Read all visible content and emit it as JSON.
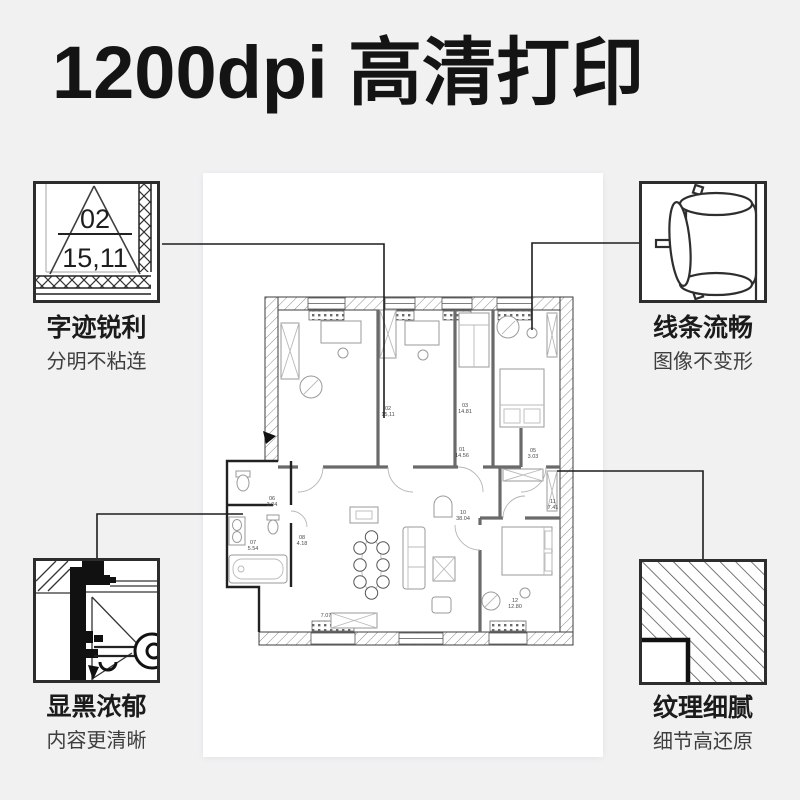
{
  "title": "1200dpi 高清打印",
  "features": {
    "top_left": {
      "title": "字迹锐利",
      "subtitle": "分明不粘连",
      "detail_number": "02",
      "detail_value": "15,11",
      "icon": "magnified-room-label"
    },
    "top_right": {
      "title": "线条流畅",
      "subtitle": "图像不变形",
      "icon": "armchair-top-view"
    },
    "bottom_left": {
      "title": "显黑浓郁",
      "subtitle": "内容更清晰",
      "icon": "wall-section-detail"
    },
    "bottom_right": {
      "title": "纹理细腻",
      "subtitle": "细节高还原",
      "icon": "hatch-texture"
    }
  },
  "floor_plan": {
    "type": "apartment-floor-plan",
    "room_labels": [
      {
        "id": "02",
        "area": "15,11"
      },
      {
        "id": "03",
        "area": "14.81"
      },
      {
        "id": "01",
        "area": "14.56"
      },
      {
        "id": "05",
        "area": "3.03"
      },
      {
        "id": "11",
        "area": "7.41"
      },
      {
        "id": "10",
        "area": "38.04"
      },
      {
        "id": "12",
        "area": "12.80"
      },
      {
        "id": "06",
        "area": "3.04"
      },
      {
        "id": "07",
        "area": "5.54"
      },
      {
        "id": "08",
        "area": "4.18"
      },
      {
        "id": "",
        "area": "7.07"
      }
    ]
  },
  "colors": {
    "background": "#f1f1f2",
    "paper": "#ffffff",
    "ink": "#141414",
    "box_border": "#2d2d2d",
    "leader_line": "#1d1d1d",
    "subtitle_text": "#3e3e3e"
  }
}
